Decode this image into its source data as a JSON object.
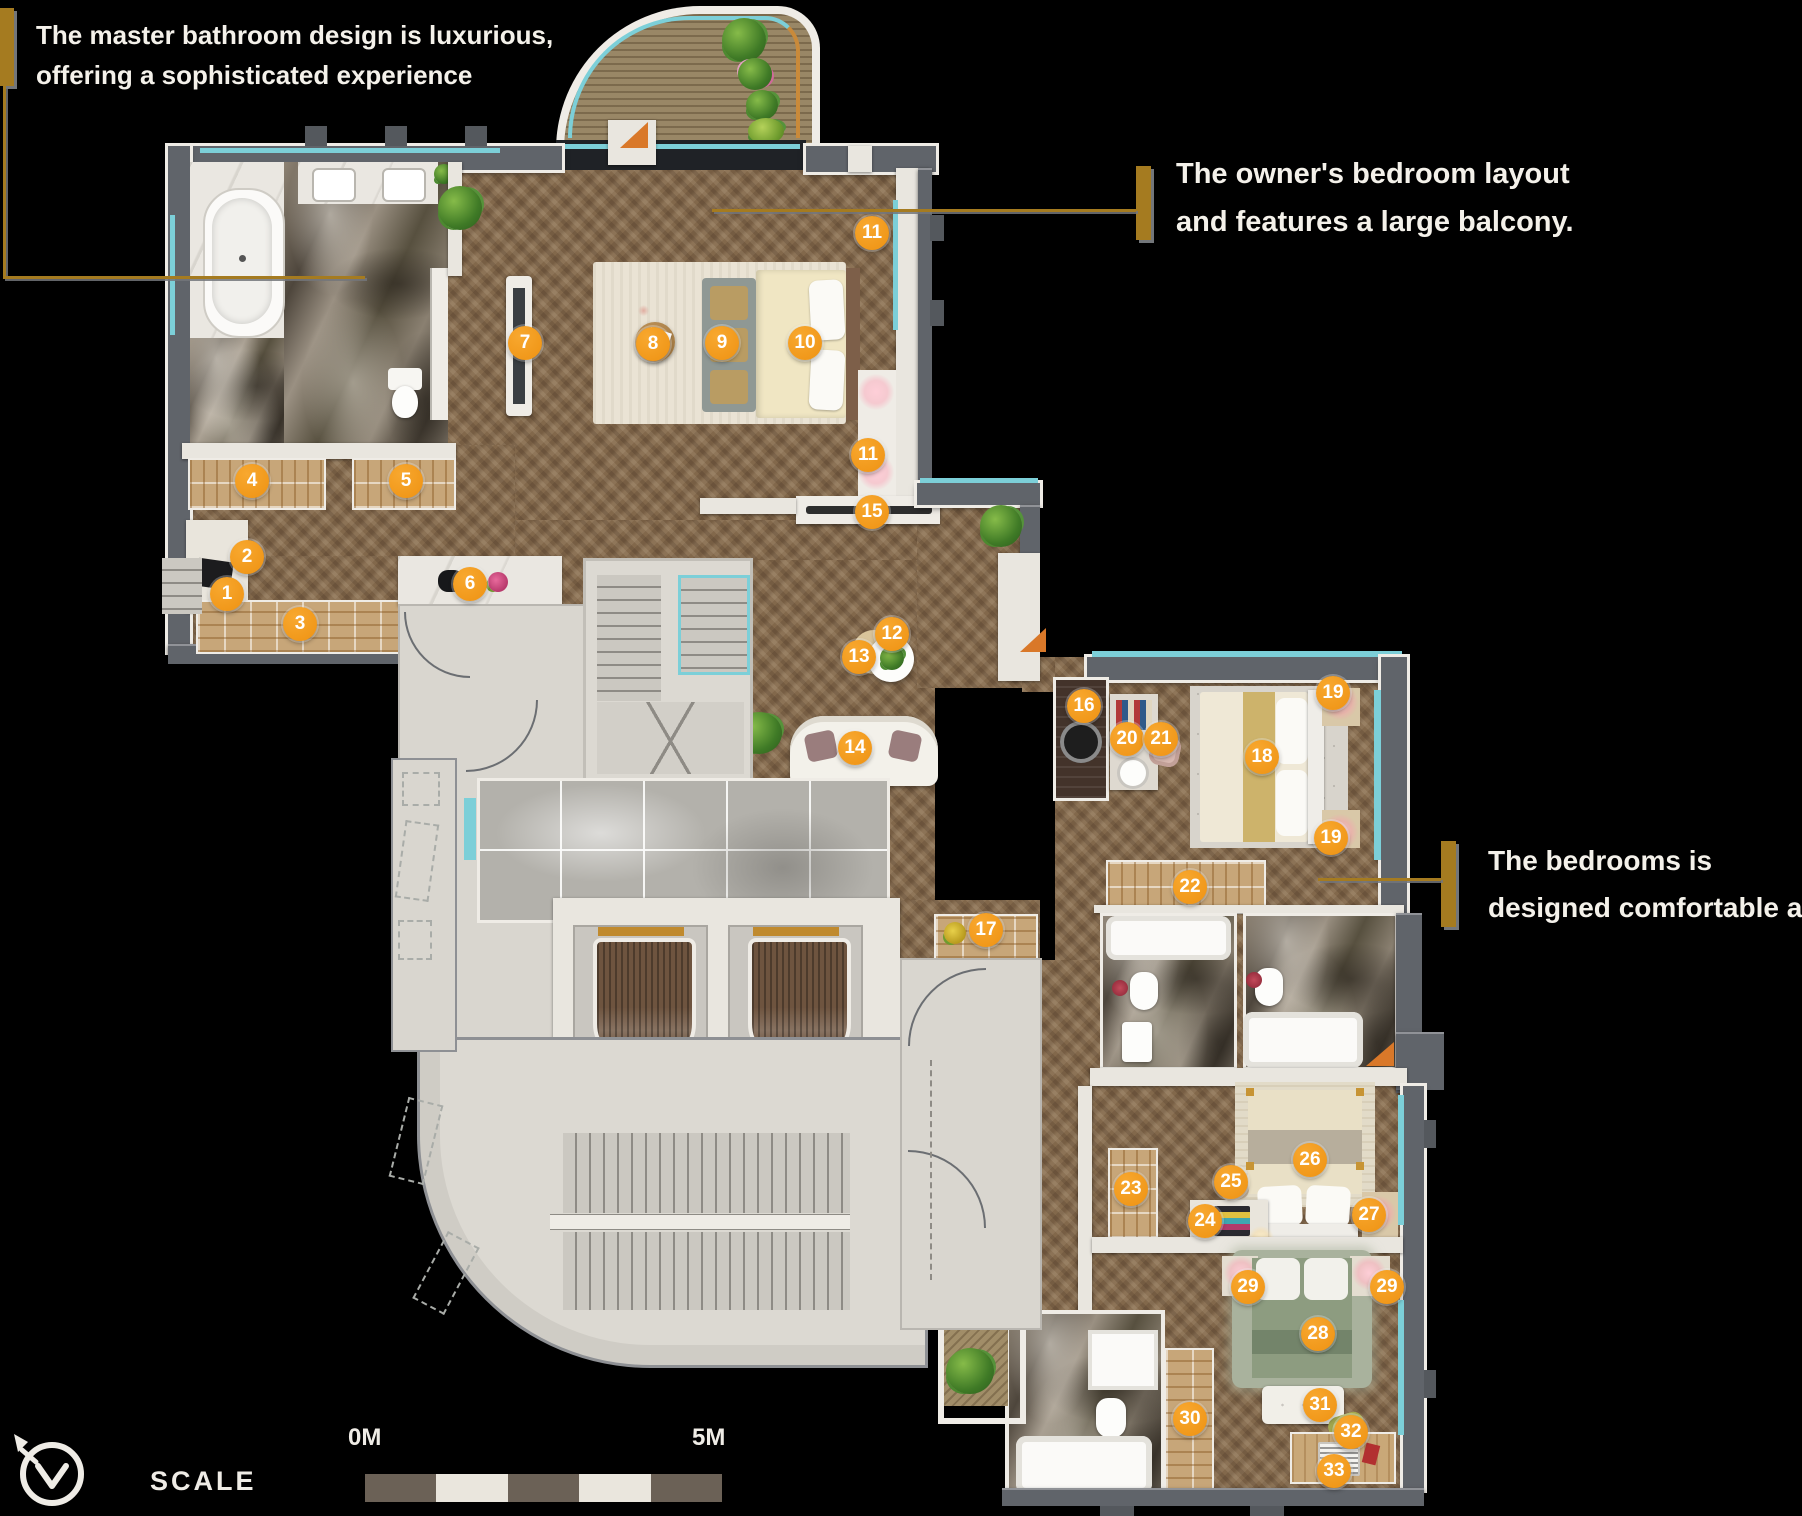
{
  "annotations": {
    "top_left": {
      "line1": "The master bathroom design is luxurious,",
      "line2": "offering a sophisticated experience"
    },
    "top_right": {
      "line1": "The owner's bedroom layout",
      "line2": "and features a large balcony."
    },
    "right": {
      "line1": "The bedrooms is",
      "line2": "designed comfortable and."
    }
  },
  "scale": {
    "label": "SCALE",
    "zero_label": "0M",
    "end_label": "5M",
    "segments": [
      "dark",
      "light",
      "dark",
      "light",
      "dark"
    ]
  },
  "compass": {
    "icon": "north-arrow"
  },
  "colors": {
    "background": "#000000",
    "marker_orange": "#F09614",
    "gold": "#A57B20",
    "glass_teal": "#7CCFD8",
    "wall_gray": "#60646A",
    "wood_floor": "#82684B",
    "scale_dark": "#6B6156",
    "scale_light": "#EAE6DD",
    "text": "#F4F1EA"
  },
  "markers": [
    {
      "n": "1",
      "x": 227,
      "y": 594
    },
    {
      "n": "2",
      "x": 247,
      "y": 557
    },
    {
      "n": "3",
      "x": 300,
      "y": 624
    },
    {
      "n": "4",
      "x": 252,
      "y": 481
    },
    {
      "n": "5",
      "x": 406,
      "y": 481
    },
    {
      "n": "6",
      "x": 470,
      "y": 584
    },
    {
      "n": "7",
      "x": 525,
      "y": 343
    },
    {
      "n": "8",
      "x": 653,
      "y": 344
    },
    {
      "n": "9",
      "x": 722,
      "y": 343
    },
    {
      "n": "10",
      "x": 805,
      "y": 343
    },
    {
      "n": "11",
      "x": 872,
      "y": 233
    },
    {
      "n": "11",
      "x": 868,
      "y": 455
    },
    {
      "n": "12",
      "x": 892,
      "y": 634
    },
    {
      "n": "13",
      "x": 859,
      "y": 657
    },
    {
      "n": "14",
      "x": 855,
      "y": 748
    },
    {
      "n": "15",
      "x": 872,
      "y": 512
    },
    {
      "n": "16",
      "x": 1084,
      "y": 706
    },
    {
      "n": "17",
      "x": 986,
      "y": 930
    },
    {
      "n": "18",
      "x": 1262,
      "y": 757
    },
    {
      "n": "19",
      "x": 1333,
      "y": 693
    },
    {
      "n": "19",
      "x": 1331,
      "y": 838
    },
    {
      "n": "20",
      "x": 1127,
      "y": 739
    },
    {
      "n": "21",
      "x": 1161,
      "y": 739
    },
    {
      "n": "22",
      "x": 1190,
      "y": 887
    },
    {
      "n": "23",
      "x": 1131,
      "y": 1189
    },
    {
      "n": "24",
      "x": 1205,
      "y": 1221
    },
    {
      "n": "25",
      "x": 1231,
      "y": 1182
    },
    {
      "n": "26",
      "x": 1310,
      "y": 1160
    },
    {
      "n": "27",
      "x": 1369,
      "y": 1215
    },
    {
      "n": "28",
      "x": 1318,
      "y": 1334
    },
    {
      "n": "29",
      "x": 1248,
      "y": 1287
    },
    {
      "n": "29",
      "x": 1387,
      "y": 1287
    },
    {
      "n": "30",
      "x": 1190,
      "y": 1419
    },
    {
      "n": "31",
      "x": 1320,
      "y": 1405
    },
    {
      "n": "32",
      "x": 1351,
      "y": 1432
    },
    {
      "n": "33",
      "x": 1334,
      "y": 1471
    }
  ]
}
